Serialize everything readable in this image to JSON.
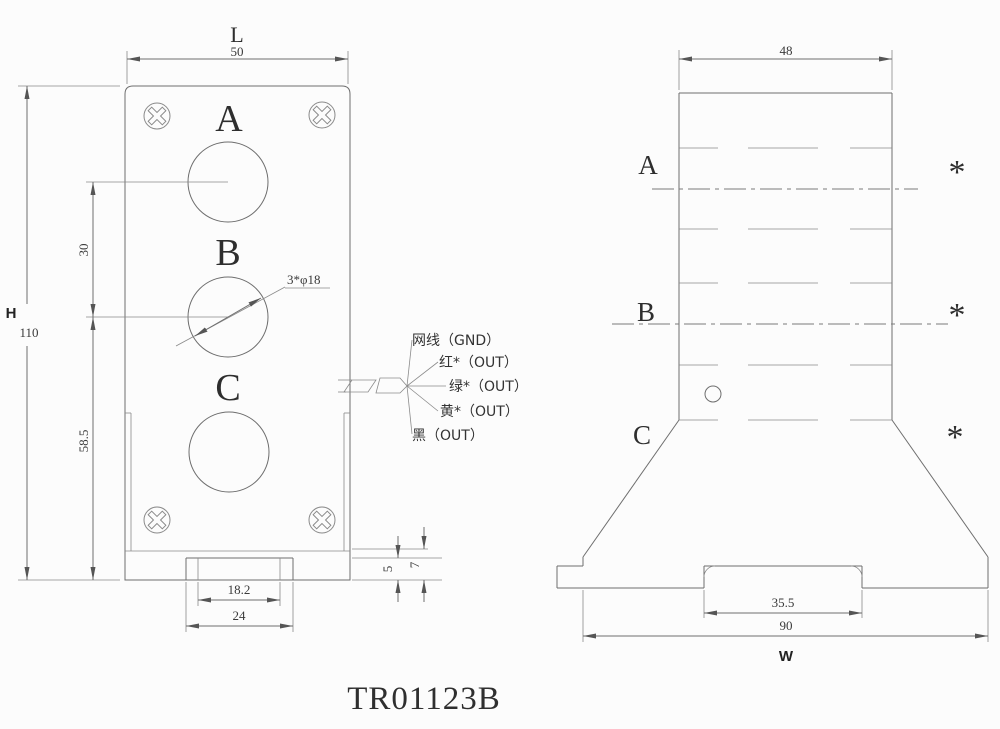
{
  "colors": {
    "line": "#6e6e6e",
    "text": "#3a3a3a",
    "background": "#fcfcfc"
  },
  "title": "TR01123B",
  "front_view": {
    "dims": {
      "width_letter": "L",
      "width": "50",
      "height_letter": "H",
      "height": "110",
      "hole_pitch": "30",
      "center_to_base": "58.5",
      "holes_note": "3*φ18",
      "slot_inner": "18.2",
      "slot_outer": "24",
      "base_step": "5",
      "base_thickness": "7"
    },
    "holes": {
      "a": "A",
      "b": "B",
      "c": "C"
    },
    "wires": [
      {
        "label": "网线（GND）"
      },
      {
        "label": "红*（OUT）"
      },
      {
        "label": "绿*（OUT）"
      },
      {
        "label": "黄*（OUT）"
      },
      {
        "label": "黑（OUT）"
      }
    ]
  },
  "side_view": {
    "dims": {
      "top_width": "48",
      "slot_width": "35.5",
      "base_width": "90",
      "base_letter": "W"
    },
    "rows": {
      "a": "A",
      "b": "B",
      "c": "C"
    },
    "marker": "*"
  }
}
